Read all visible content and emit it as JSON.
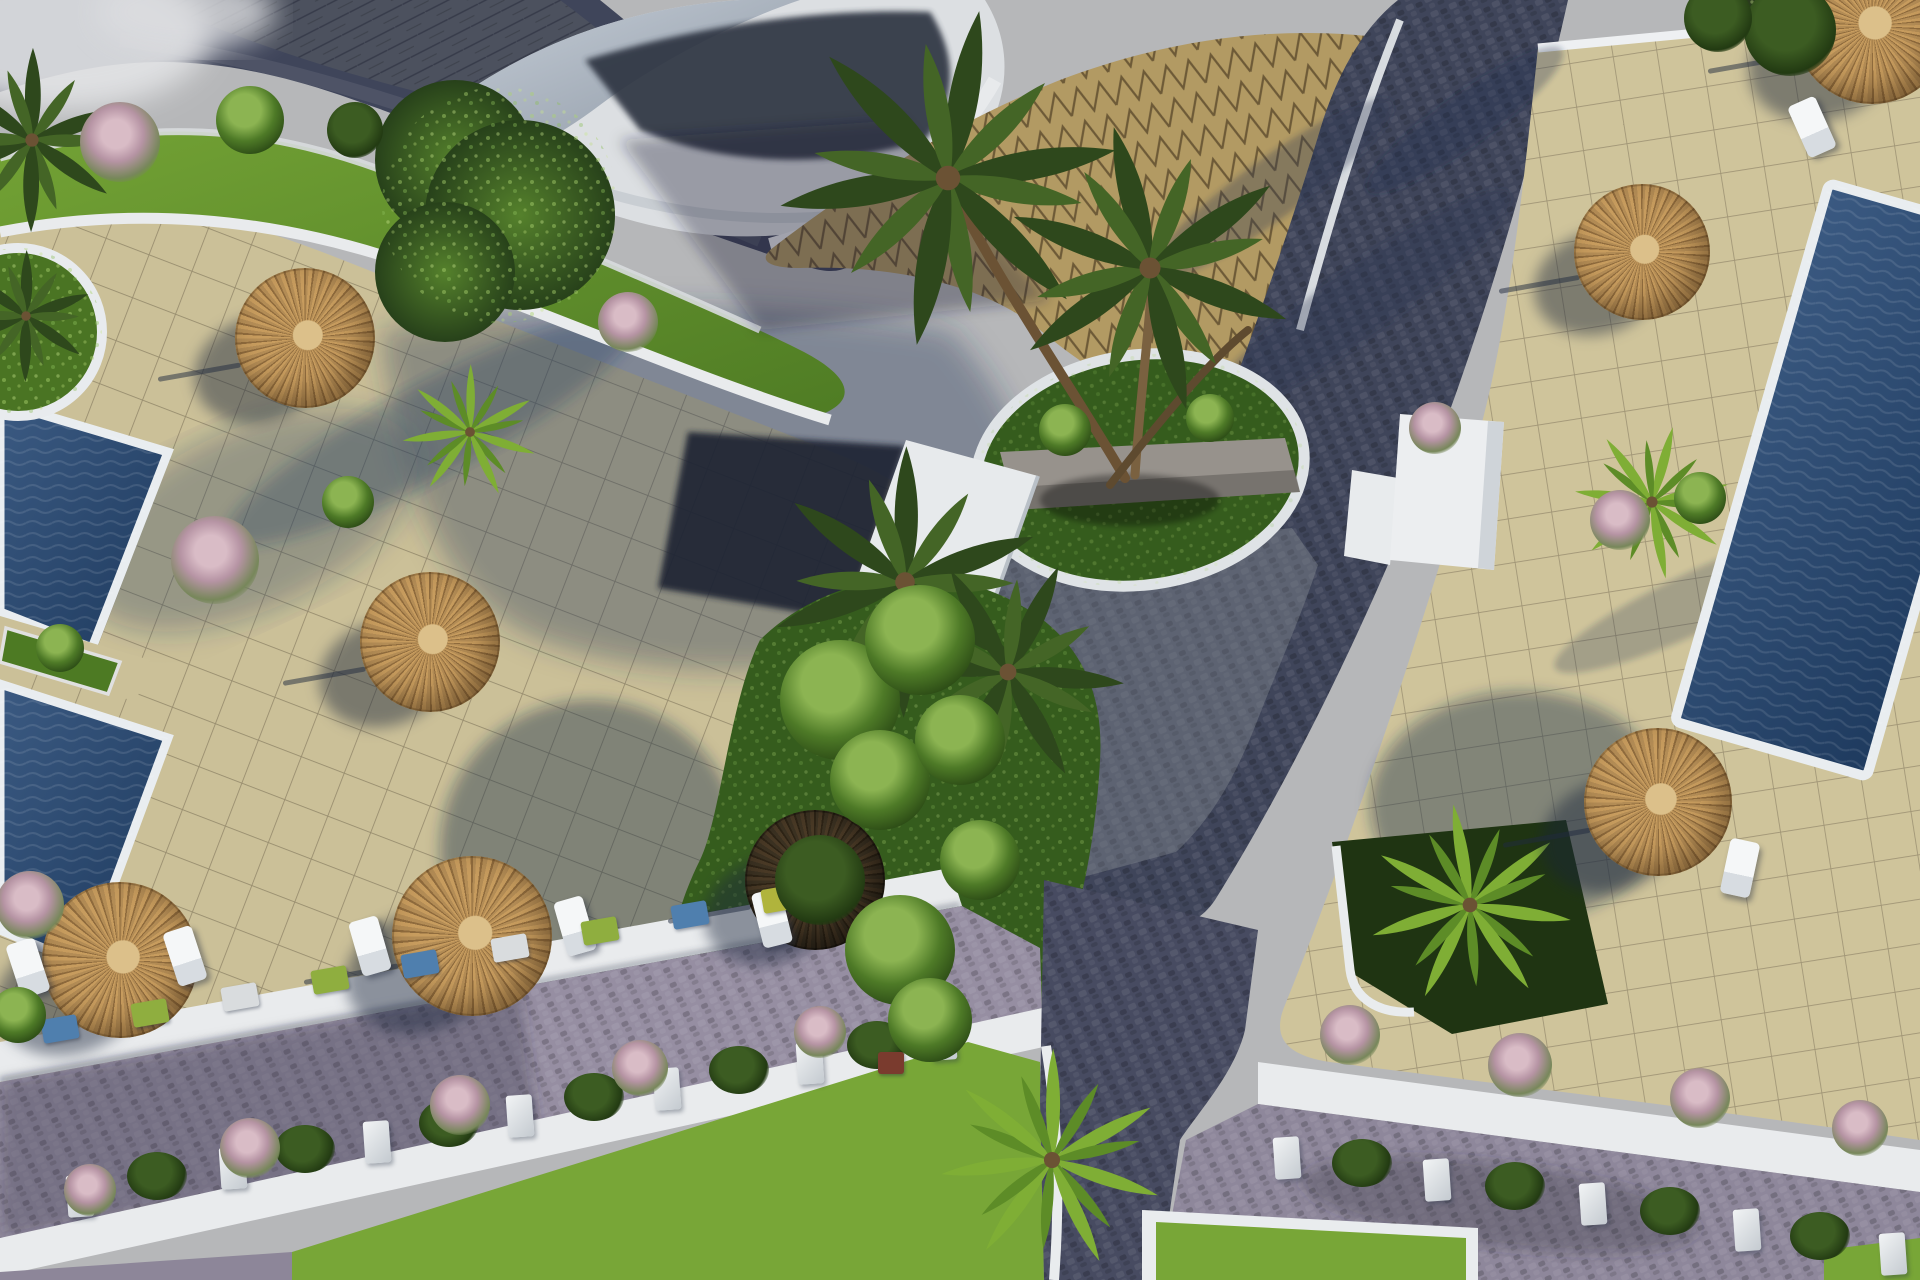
{
  "meta": {
    "description": "Aerial 3D architectural rendering of a resort courtyard: swimming pools, straw parasols with sun loungers, palm trees, beige paved terraces, a curved white building with gold zigzag tiling, navy cobblestone paths and planter-lined roads with lawns",
    "view": "top-down oblique render",
    "visible_text": []
  },
  "colors": {
    "sky": "#b6b7b9",
    "tile": "#cbc098",
    "grout": "#8a7f63",
    "tileR": "#cfc49b",
    "groutR": "#93886b",
    "gold": "#b29a63",
    "goldline": "#6d5a37",
    "navy": "#3f455a",
    "navy2": "#474b61",
    "roadlav": "#968ea2",
    "white": "#e9ebed",
    "poolA": "#3b5a82",
    "poolB": "#1e3a5e",
    "grass": "#78a637",
    "grassup": "#5b8230",
    "island": "#355c1d",
    "bush": "#87b148",
    "trunk": "#6b5234",
    "stone": "#97928c",
    "hedge": "#2a3b1d",
    "building": "#dcdfe2",
    "buildingdark": "#2d3442",
    "rooftex": "#4d525e",
    "kiosk": "#eceef0",
    "straw_a": "#c79c5e",
    "straw_b": "#8f6b3d",
    "straw_c": "#b38c55",
    "straw_center": "#dcc08a",
    "umbrella_dark": "#3a2e1f",
    "flower_pink": "#c9a8b4"
  },
  "scene": {
    "umbrellas": [
      {
        "x": 305,
        "y": 338,
        "r": 70,
        "variant": "straw"
      },
      {
        "x": 430,
        "y": 642,
        "r": 70,
        "variant": "straw"
      },
      {
        "x": 120,
        "y": 960,
        "r": 78,
        "variant": "straw"
      },
      {
        "x": 472,
        "y": 936,
        "r": 80,
        "variant": "straw"
      },
      {
        "x": 815,
        "y": 880,
        "r": 70,
        "variant": "dark"
      },
      {
        "x": 1642,
        "y": 252,
        "r": 68,
        "variant": "straw"
      },
      {
        "x": 1658,
        "y": 802,
        "r": 74,
        "variant": "straw"
      },
      {
        "x": 1872,
        "y": 26,
        "r": 78,
        "variant": "straw"
      }
    ],
    "loungers": [
      {
        "x": 28,
        "y": 968,
        "a": -18
      },
      {
        "x": 185,
        "y": 956,
        "a": -18
      },
      {
        "x": 370,
        "y": 946,
        "a": -16
      },
      {
        "x": 575,
        "y": 926,
        "a": -16
      },
      {
        "x": 772,
        "y": 918,
        "a": -14
      },
      {
        "x": 1740,
        "y": 868,
        "a": 12
      },
      {
        "x": 1812,
        "y": 127,
        "a": -24
      }
    ],
    "palms": [
      {
        "x": 948,
        "y": 178,
        "r": 175,
        "variant": "dark",
        "rot": 10
      },
      {
        "x": 1150,
        "y": 268,
        "r": 150,
        "variant": "dark",
        "rot": -15
      },
      {
        "x": 905,
        "y": 582,
        "r": 140,
        "variant": "dark",
        "rot": 0
      },
      {
        "x": 1008,
        "y": 672,
        "r": 120,
        "variant": "dark",
        "rot": 25
      },
      {
        "x": 32,
        "y": 140,
        "r": 95,
        "variant": "dark",
        "rot": 0
      },
      {
        "x": 26,
        "y": 316,
        "r": 68,
        "variant": "dark",
        "rot": 0
      },
      {
        "x": 1052,
        "y": 1160,
        "r": 115,
        "variant": "bright",
        "rot": 0
      },
      {
        "x": 1470,
        "y": 905,
        "r": 105,
        "variant": "bright",
        "rot": -10
      },
      {
        "x": 1652,
        "y": 502,
        "r": 80,
        "variant": "bright",
        "rot": 15
      },
      {
        "x": 470,
        "y": 432,
        "r": 70,
        "variant": "bright",
        "rot": 0
      }
    ],
    "mini_planters": [
      {
        "x": 60,
        "y": 1029,
        "c": "#4f7fae"
      },
      {
        "x": 150,
        "y": 1013,
        "c": "#8fae3f"
      },
      {
        "x": 240,
        "y": 997,
        "c": "#d9dcde"
      },
      {
        "x": 330,
        "y": 980,
        "c": "#8fae3f"
      },
      {
        "x": 420,
        "y": 964,
        "c": "#4f7fae"
      },
      {
        "x": 510,
        "y": 948,
        "c": "#d9dcde"
      },
      {
        "x": 600,
        "y": 931,
        "c": "#8fae3f"
      },
      {
        "x": 690,
        "y": 915,
        "c": "#4f7fae"
      },
      {
        "x": 780,
        "y": 899,
        "c": "#b0b43c"
      }
    ],
    "planter_posts": {
      "left": [
        {
          "x": 80,
          "y": 1196
        },
        {
          "x": 233,
          "y": 1168
        },
        {
          "x": 377,
          "y": 1142
        },
        {
          "x": 520,
          "y": 1116
        },
        {
          "x": 667,
          "y": 1089
        },
        {
          "x": 810,
          "y": 1063
        },
        {
          "x": 943,
          "y": 1039
        }
      ],
      "right": [
        {
          "x": 1287,
          "y": 1158
        },
        {
          "x": 1437,
          "y": 1180
        },
        {
          "x": 1593,
          "y": 1204
        },
        {
          "x": 1747,
          "y": 1230
        },
        {
          "x": 1893,
          "y": 1254
        }
      ]
    },
    "shrubs": [
      {
        "x": 215,
        "y": 560,
        "r": 44,
        "t": "pink"
      },
      {
        "x": 348,
        "y": 502,
        "r": 26,
        "t": "green"
      },
      {
        "x": 628,
        "y": 322,
        "r": 30,
        "t": "pink"
      },
      {
        "x": 120,
        "y": 142,
        "r": 40,
        "t": "pink"
      },
      {
        "x": 250,
        "y": 120,
        "r": 34,
        "t": "green"
      },
      {
        "x": 355,
        "y": 130,
        "r": 28,
        "t": "dark"
      },
      {
        "x": 60,
        "y": 648,
        "r": 24,
        "t": "green"
      },
      {
        "x": 30,
        "y": 905,
        "r": 34,
        "t": "pink"
      },
      {
        "x": 18,
        "y": 1015,
        "r": 28,
        "t": "green"
      },
      {
        "x": 840,
        "y": 700,
        "r": 60,
        "t": "green"
      },
      {
        "x": 920,
        "y": 640,
        "r": 55,
        "t": "green"
      },
      {
        "x": 880,
        "y": 780,
        "r": 50,
        "t": "green"
      },
      {
        "x": 960,
        "y": 740,
        "r": 45,
        "t": "green"
      },
      {
        "x": 820,
        "y": 880,
        "r": 45,
        "t": "dark"
      },
      {
        "x": 900,
        "y": 950,
        "r": 55,
        "t": "green"
      },
      {
        "x": 980,
        "y": 860,
        "r": 40,
        "t": "green"
      },
      {
        "x": 930,
        "y": 1020,
        "r": 42,
        "t": "green"
      },
      {
        "x": 460,
        "y": 1105,
        "r": 30,
        "t": "pink"
      },
      {
        "x": 640,
        "y": 1068,
        "r": 28,
        "t": "pink"
      },
      {
        "x": 820,
        "y": 1032,
        "r": 26,
        "t": "pink"
      },
      {
        "x": 250,
        "y": 1148,
        "r": 30,
        "t": "pink"
      },
      {
        "x": 90,
        "y": 1190,
        "r": 26,
        "t": "pink"
      },
      {
        "x": 1350,
        "y": 1035,
        "r": 30,
        "t": "pink"
      },
      {
        "x": 1520,
        "y": 1065,
        "r": 32,
        "t": "pink"
      },
      {
        "x": 1700,
        "y": 1098,
        "r": 30,
        "t": "pink"
      },
      {
        "x": 1860,
        "y": 1128,
        "r": 28,
        "t": "pink"
      },
      {
        "x": 1435,
        "y": 428,
        "r": 26,
        "t": "pink"
      },
      {
        "x": 1620,
        "y": 520,
        "r": 30,
        "t": "pink"
      },
      {
        "x": 1700,
        "y": 498,
        "r": 26,
        "t": "green"
      },
      {
        "x": 1065,
        "y": 430,
        "r": 26,
        "t": "green"
      },
      {
        "x": 1210,
        "y": 418,
        "r": 24,
        "t": "green"
      },
      {
        "x": 1790,
        "y": 30,
        "r": 46,
        "t": "dark"
      },
      {
        "x": 1718,
        "y": 18,
        "r": 34,
        "t": "dark"
      }
    ],
    "accents": [
      {
        "type": "crate",
        "x": 878,
        "y": 1052,
        "w": 26,
        "h": 22,
        "color": "#7a3b2e"
      }
    ]
  }
}
